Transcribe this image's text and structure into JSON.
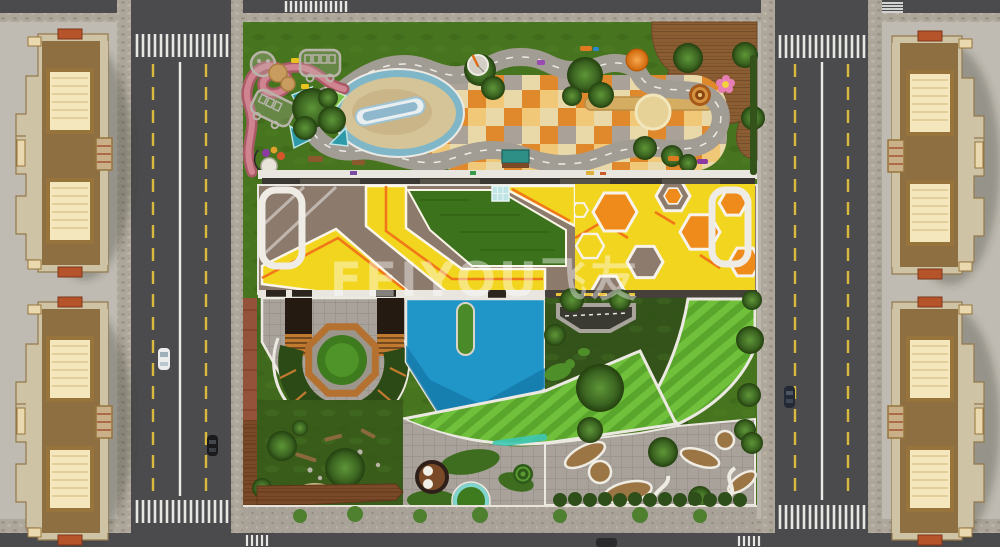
{
  "watermark": {
    "text": "FEIYOU飞友"
  },
  "palette": {
    "ground": "#bab6ad",
    "asphalt": "#4b4b4d",
    "sidewalk_cobble": "#ada79b",
    "lane_white": "#ebebe8",
    "lane_yellow": "#d9ba3e",
    "grass_play": "#47741f",
    "grass_dark": "#3a5c1b",
    "play_road": "#a29d94",
    "track_pink": "#cf8490",
    "pond_ring": "#7fb7c9",
    "pond_sand": "#d5c498",
    "checker_orange": "#e0892c",
    "checker_gold": "#f0c878",
    "checker_cream": "#e9d9a9",
    "roof_taupe": "#8c7a6c",
    "roof_yellow": "#f2d51e",
    "roof_orange": "#ef8b1a",
    "roof_lawn": "#3c721c",
    "pool_blue": "#2095c8",
    "lawn_stripe_a": "#5aa62c",
    "lawn_stripe_b": "#70c03c",
    "deck_wood": "#96683a",
    "deck_dark": "#7a4a28",
    "paver": "#a6a198",
    "soil": "#9c7544",
    "building_tan": "#a98a5c",
    "building_roof": "#8d6f42",
    "building_cream": "#f4e6bd",
    "building_edge": "#cfc3a6",
    "building_accent": "#b5532a",
    "watermark_color": "rgba(255,255,255,0.42)"
  },
  "vehicles": [
    {
      "name": "white-car-left-road",
      "color": "#ececec"
    },
    {
      "name": "black-car-left-road",
      "color": "#1a1a1c"
    },
    {
      "name": "dark-car-right-road",
      "color": "#232a36"
    },
    {
      "name": "dark-car-bottom-road",
      "color": "#2b2b2d"
    }
  ]
}
